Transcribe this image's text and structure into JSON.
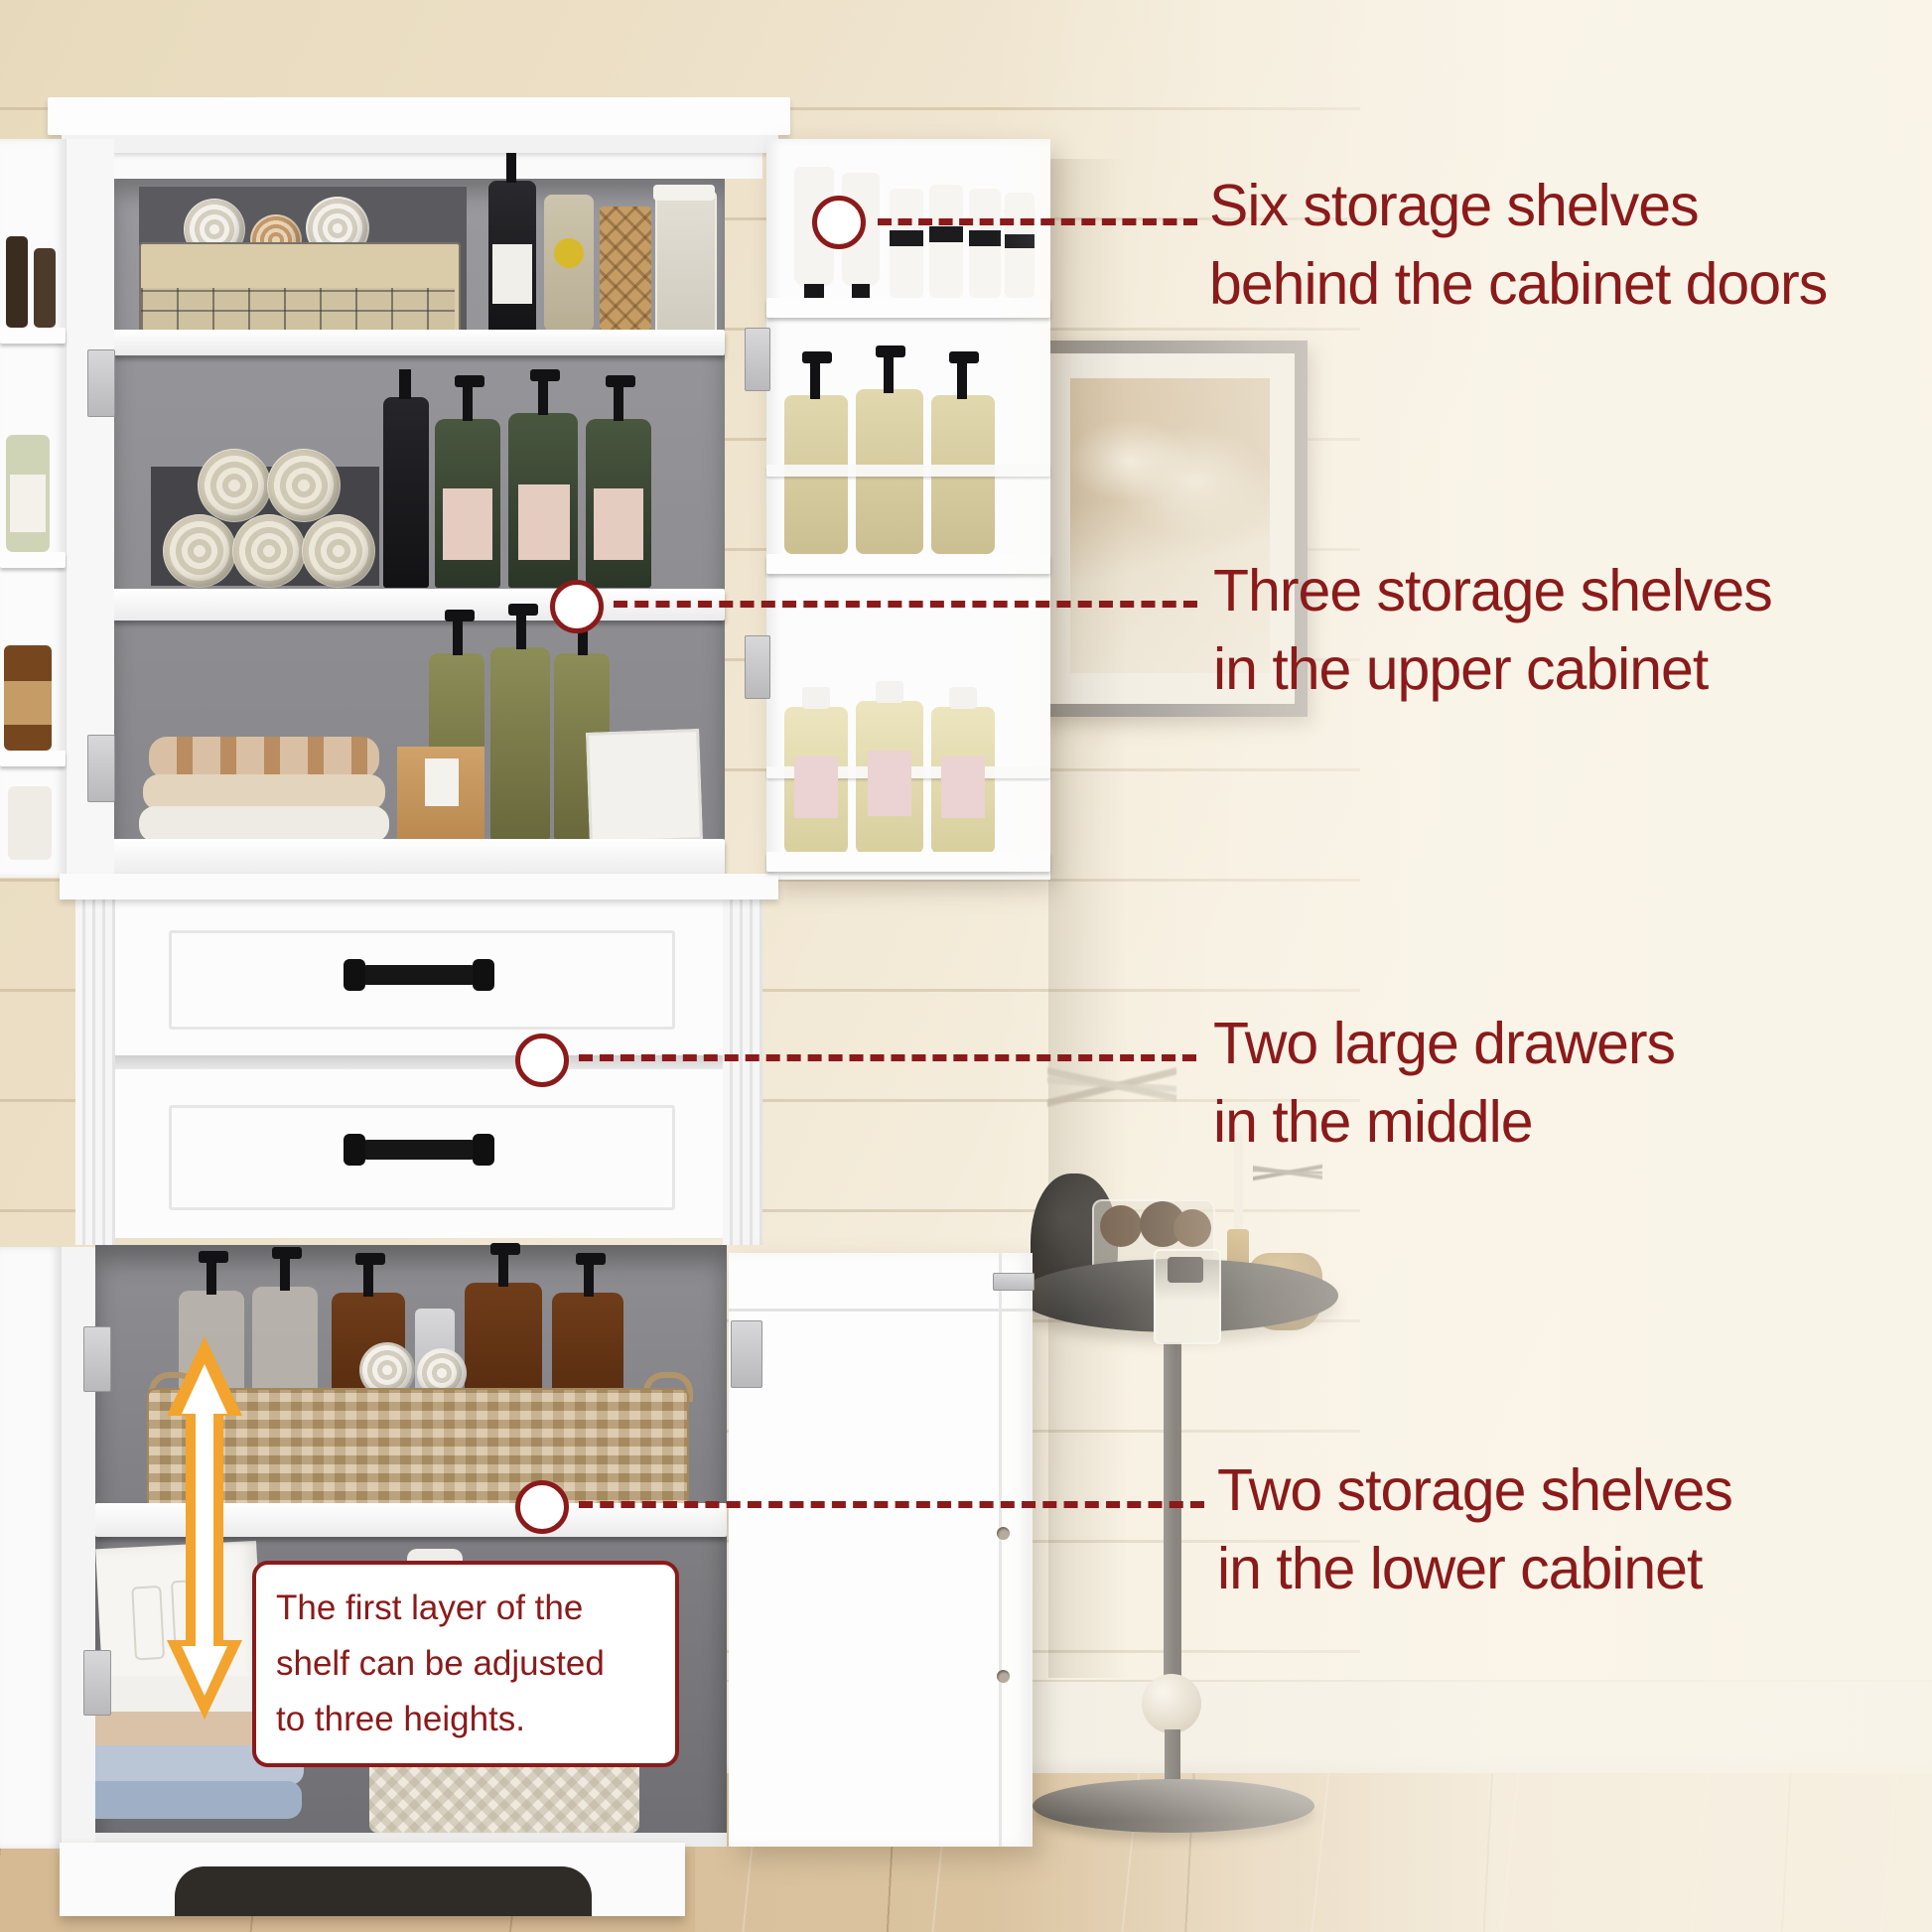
{
  "annotations": [
    {
      "line1": "Six storage shelves",
      "line2": "behind the cabinet doors"
    },
    {
      "line1": "Three storage shelves",
      "line2": "in the upper cabinet"
    },
    {
      "line1": "Two large drawers",
      "line2": "in the middle"
    },
    {
      "line1": "Two storage shelves",
      "line2": "in the lower cabinet"
    }
  ],
  "callout": {
    "lines": [
      "The first layer of the",
      "shelf can be adjusted",
      "to three heights."
    ]
  },
  "colors": {
    "annotation_red": "#8B1A1A",
    "arrow_orange": "#F2A42E",
    "cabinet_white": "#FCFCFC",
    "wall_cream": "#F0E6CF",
    "floor_wood": "#D8BF9C",
    "interior_gray": "#909094"
  },
  "icons": {
    "marker": "circle-marker",
    "leader": "dashed-leader-line",
    "height_adjust": "double-headed-arrow"
  }
}
